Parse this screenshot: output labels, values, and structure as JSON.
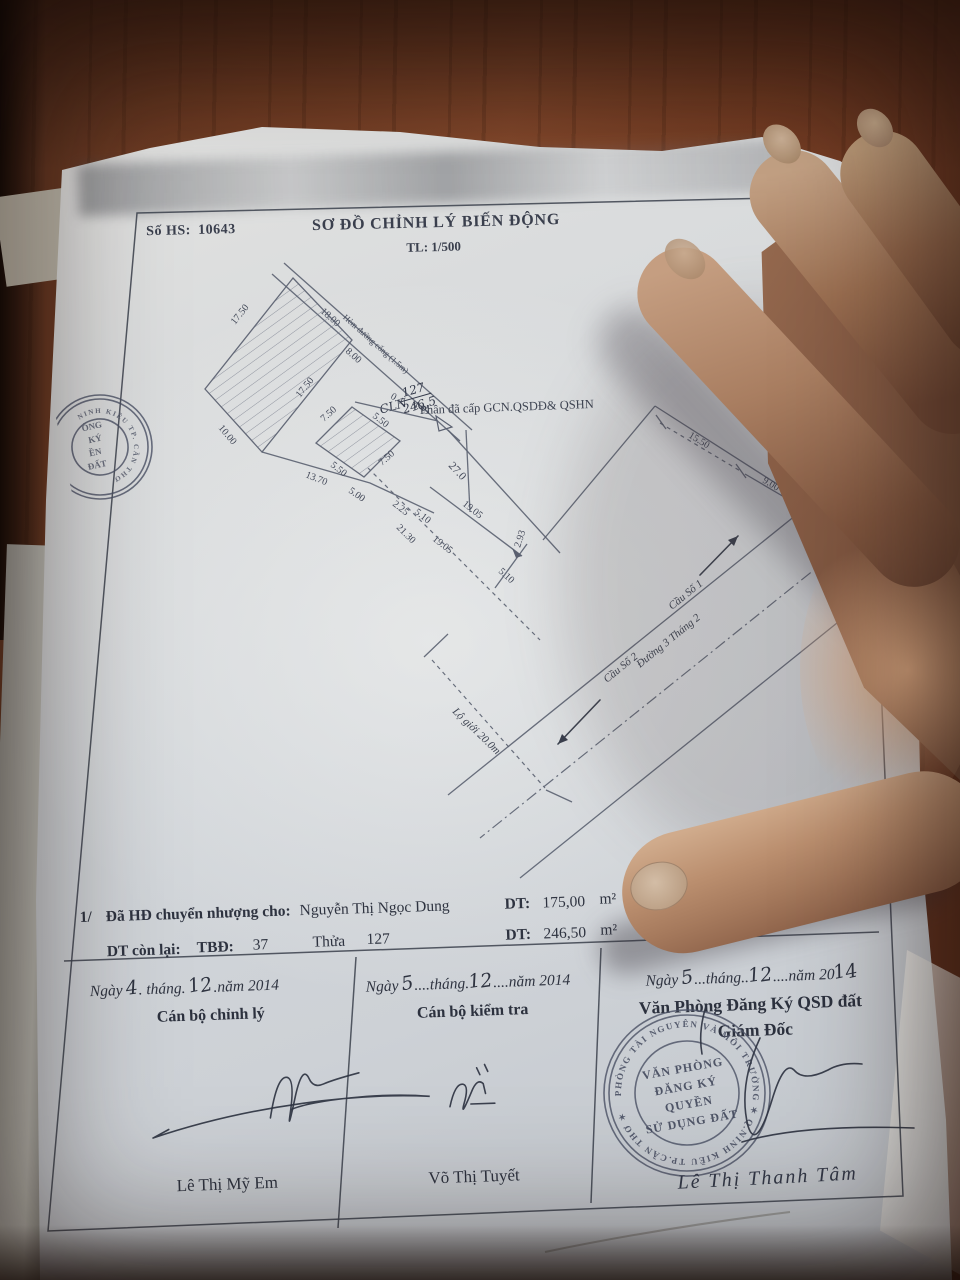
{
  "header": {
    "file_label": "Số HS:",
    "file_number": "10643",
    "title": "SƠ ĐỒ CHỈNH LÝ BIẾN ĐỘNG",
    "scale": "TL: 1/500"
  },
  "map": {
    "alley_label": "Hẻm đường cống (1.5m)",
    "granted_label": "Phần  đã cấp GCN.QSDĐ& QSHN",
    "parcel_handwritten": {
      "land_type": "CLN",
      "plot": "127",
      "area": "246.5"
    },
    "dims": [
      "17.50",
      "10.00",
      "13.70",
      "17.50",
      "18.00",
      "8.00",
      "0.4",
      "4.45",
      "7.50",
      "5.50",
      "7.50",
      "5.50",
      "5.00",
      "2.25",
      "5.10",
      "27.0",
      "19.05",
      "19.05",
      "21.30",
      "5.10",
      "2.93",
      "15.50",
      "9.00"
    ],
    "road": {
      "bridge1": "Cầu Số 1",
      "bridge2": "Cầu Số 2",
      "street": "Đường 3 Tháng 2",
      "setback": "Lộ giới 20.0m"
    }
  },
  "info": {
    "row1": {
      "index": "1/",
      "label": "Đã HĐ chuyển nhượng cho:",
      "name": "Nguyễn Thị Ngọc Dung",
      "dt_label": "DT:",
      "dt_value": "175,00",
      "unit": "m²"
    },
    "row2": {
      "label": "DT còn lại:",
      "tbd_label": "TBĐ:",
      "tbd_value": "37",
      "thua_label": "Thửa",
      "thua_value": "127",
      "dt_label": "DT:",
      "dt_value": "246,50",
      "unit": "m²",
      "land_type": "CLN"
    }
  },
  "signatures": {
    "left": {
      "pre": "Ngày",
      "day": "4",
      "mid": ". tháng. ",
      "month": "12",
      "tail": ".năm 2014",
      "role": "Cán bộ chỉnh lý",
      "name": "Lê Thị Mỹ Em"
    },
    "middle": {
      "pre": "Ngày ",
      "day": "5",
      "mid": "....tháng.",
      "month": "12",
      "tail": "....năm 2014",
      "role": "Cán bộ kiểm tra",
      "name": "Võ Thị Tuyết"
    },
    "right": {
      "pre": "Ngày ",
      "day": "5",
      "mid": "...tháng..",
      "month": "12",
      "tail": "....năm 20",
      "year_hw": "14",
      "org": "Văn Phòng Đăng Ký QSD đất",
      "role": "Giám Đốc",
      "name": "Lê Thị Thanh Tâm"
    }
  },
  "stamp": {
    "ring_text": "PHÒNG TÀI NGUYÊN VÀ MÔI TRƯỜNG ✶ Q.NINH KIỀU TP.CẦN THƠ ✶",
    "center_line1": "VĂN PHÒNG",
    "center_line2": "ĐĂNG KÝ",
    "center_line3": "QUYỀN",
    "center_line4": "SỬ DỤNG ĐẤT"
  },
  "left_stamp": {
    "ring_text": "NINH KIỀU TP. CẦN THƠ",
    "frag1": "ÒNG",
    "frag2": "KÝ",
    "frag3": "ỀN",
    "frag4": "ĐẤT"
  },
  "colors": {
    "ink": "#3a3f4d",
    "stamp": "#4a5064",
    "paper": "#d2d6da",
    "wood": "#7c4227",
    "skin": "#b98f6f"
  }
}
